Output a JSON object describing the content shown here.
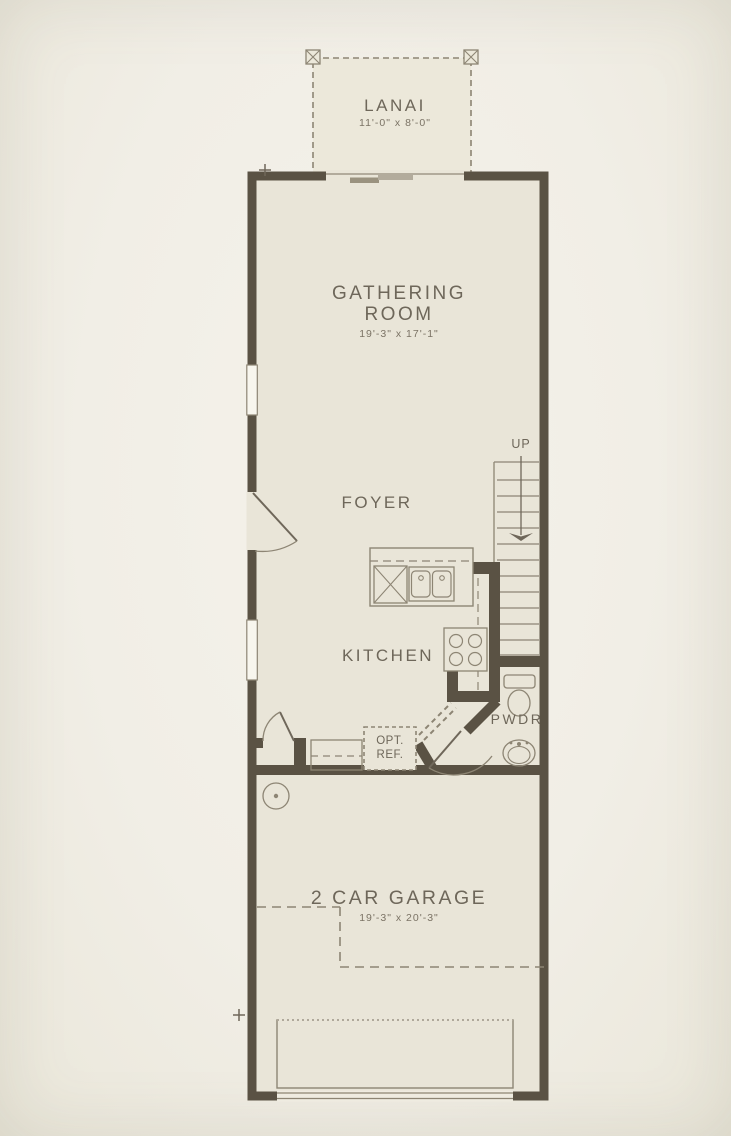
{
  "colors": {
    "wall": "#5a5244",
    "fixture_line": "#8d8574",
    "floor": "#e9e5d8",
    "lanai_floor": "#ece8da",
    "background": "#f1eee6",
    "text": "#6e675a"
  },
  "rooms": {
    "lanai": {
      "name": "LANAI",
      "dim": "11'-0\" x 8'-0\""
    },
    "gathering_room": {
      "name": "GATHERING ROOM",
      "dim": "19'-3\" x 17'-1\""
    },
    "foyer": {
      "name": "FOYER"
    },
    "kitchen": {
      "name": "KITCHEN"
    },
    "powder_room": {
      "name": "PWDR"
    },
    "garage": {
      "name": "2 CAR GARAGE",
      "dim": "19'-3\" x 20'-3\""
    }
  },
  "annotations": {
    "stairs_direction": "UP",
    "optional_refrigerator": {
      "line1": "OPT.",
      "line2": "REF."
    }
  }
}
